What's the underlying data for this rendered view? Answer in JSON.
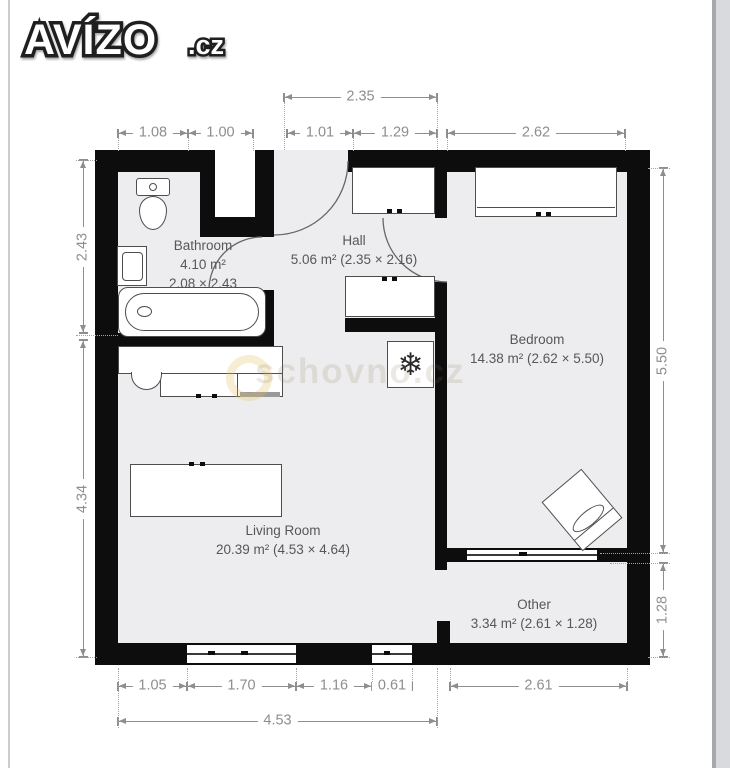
{
  "logo": {
    "title": "AVÍZO",
    "suffix": ".cz"
  },
  "watermark": {
    "text": "schovno.cz"
  },
  "rooms": {
    "bathroom": {
      "name": "Bathroom",
      "area": "4.10 m²",
      "size": "2.08 × 2.43"
    },
    "hall": {
      "name": "Hall",
      "info": "5.06 m² (2.35 × 2.16)"
    },
    "bedroom": {
      "name": "Bedroom",
      "info": "14.38 m² (2.62 × 5.50)"
    },
    "living": {
      "name": "Living Room",
      "info": "20.39 m² (4.53 × 4.64)"
    },
    "other": {
      "name": "Other",
      "info": "3.34 m² (2.61 × 1.28)"
    }
  },
  "dims": {
    "top_hall": "2.35",
    "t1": "1.08",
    "t2": "1.00",
    "t3": "1.01",
    "t4": "1.29",
    "t5": "2.62",
    "l1": "2.43",
    "l2": "4.34",
    "r1": "5.50",
    "r2": "1.28",
    "b1": "1.05",
    "b2": "1.70",
    "b3": "1.16",
    "b4": "0.61",
    "b5": "2.61",
    "b_total": "4.53"
  },
  "icons": {
    "fridge_glyph": "❄"
  },
  "colors": {
    "wall": "#0d0d0d",
    "floor": "#ededef",
    "dimension": "#8e8e8e",
    "label": "#575757"
  }
}
